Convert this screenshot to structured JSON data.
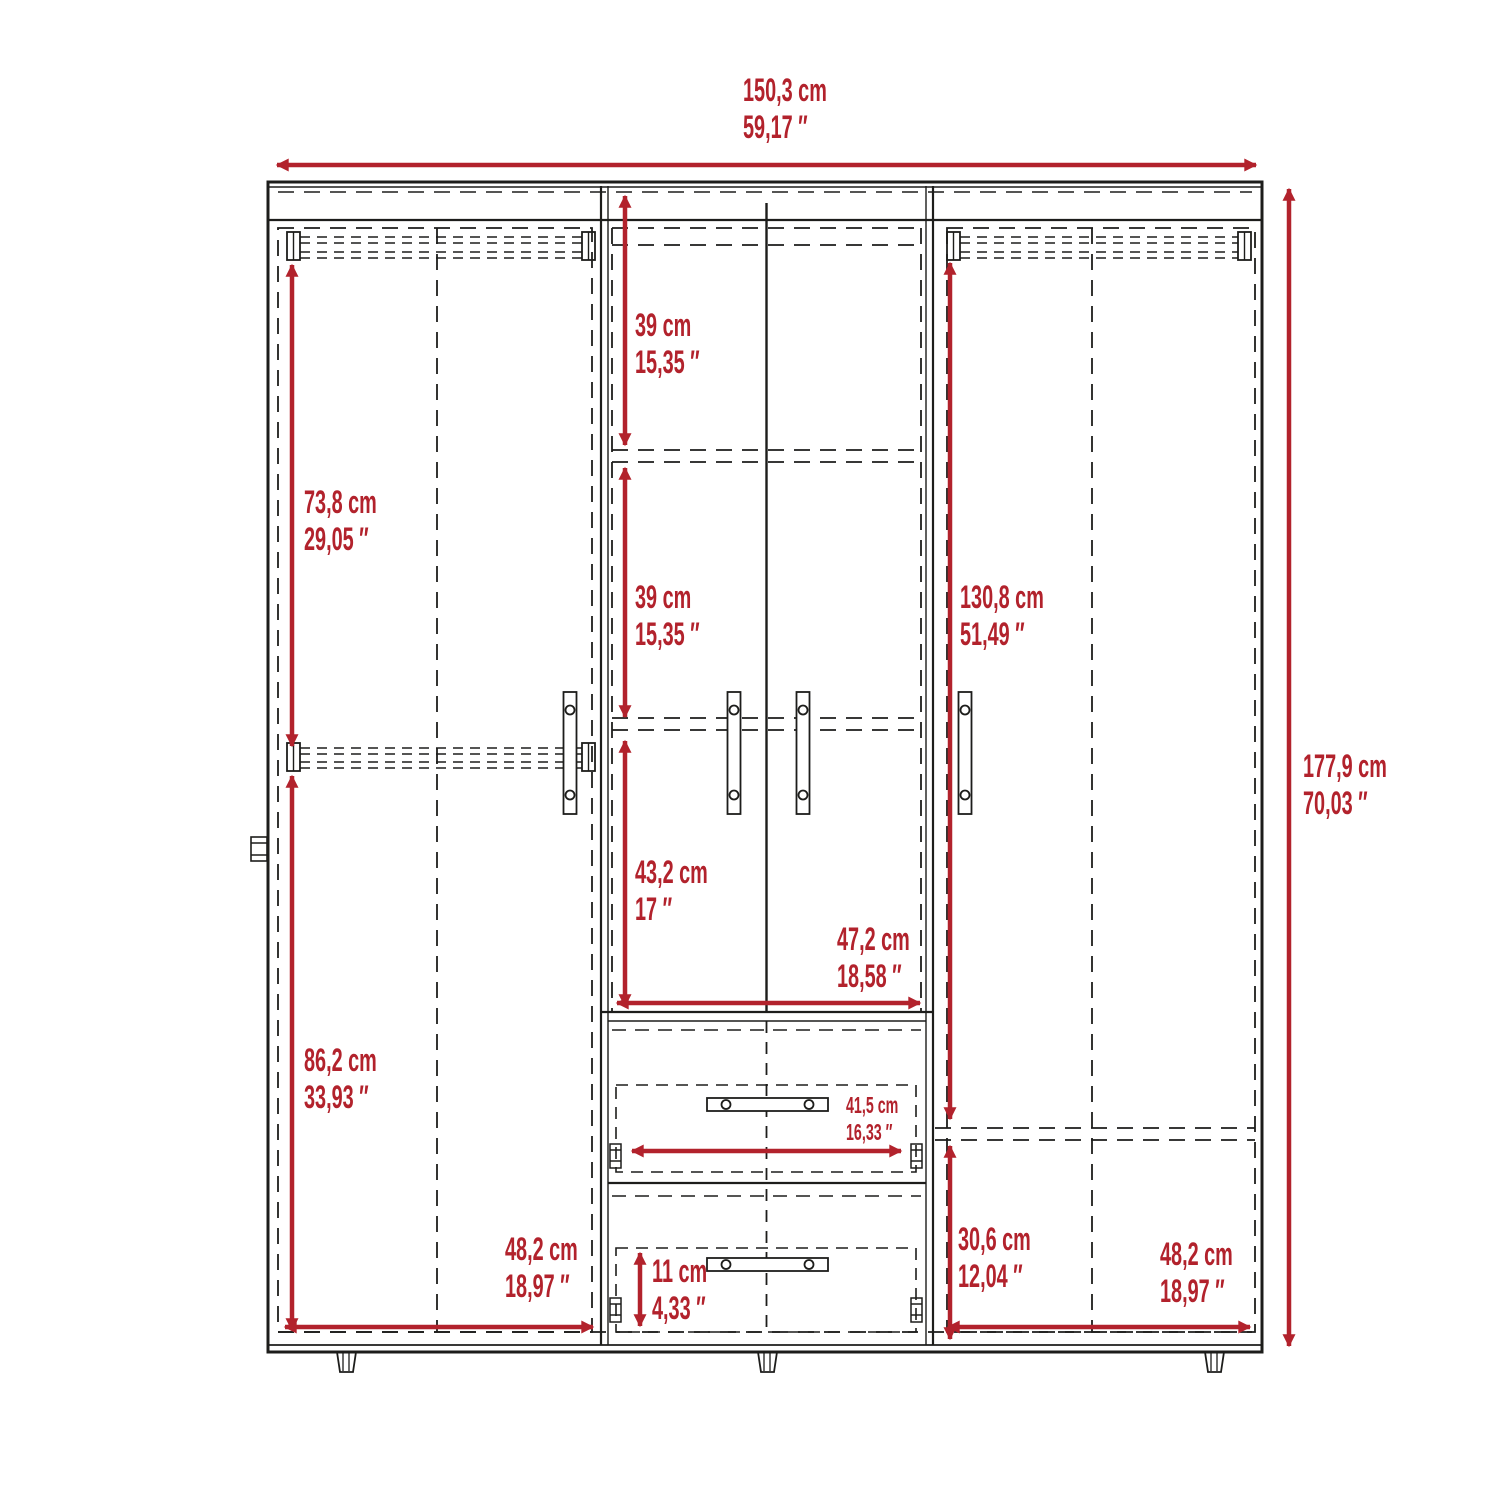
{
  "diagram_type": "wardrobe-dimension-drawing",
  "colors": {
    "dimension_red": "#b2222c",
    "line_black": "#1d1d1b",
    "background": "#ffffff"
  },
  "dimensions": {
    "overall_width": {
      "cm": "150,3 cm",
      "in": "59,17 ″"
    },
    "overall_height": {
      "cm": "177,9 cm",
      "in": "70,03 ″"
    },
    "left_upper_section_height": {
      "cm": "73,8 cm",
      "in": "29,05 ″"
    },
    "left_lower_section_height": {
      "cm": "86,2 cm",
      "in": "33,93 ″"
    },
    "center_top_shelf_height": {
      "cm": "39 cm",
      "in": "15,35 ″"
    },
    "center_middle_shelf_height": {
      "cm": "39 cm",
      "in": "15,35 ″"
    },
    "right_hanging_height": {
      "cm": "130,8 cm",
      "in": "51,49 ″"
    },
    "center_lower_section_height": {
      "cm": "43,2 cm",
      "in": "17 ″"
    },
    "center_section_width": {
      "cm": "47,2 cm",
      "in": "18,58 ″"
    },
    "drawer_interior_width": {
      "cm": "41,5 cm",
      "in": "16,33 ″"
    },
    "drawer_height": {
      "cm": "11 cm",
      "in": "4,33 ″"
    },
    "left_section_width": {
      "cm": "48,2 cm",
      "in": "18,97 ″"
    },
    "right_lower_section_height": {
      "cm": "30,6 cm",
      "in": "12,04 ″"
    },
    "right_section_width": {
      "cm": "48,2 cm",
      "in": "18,97 ″"
    }
  }
}
